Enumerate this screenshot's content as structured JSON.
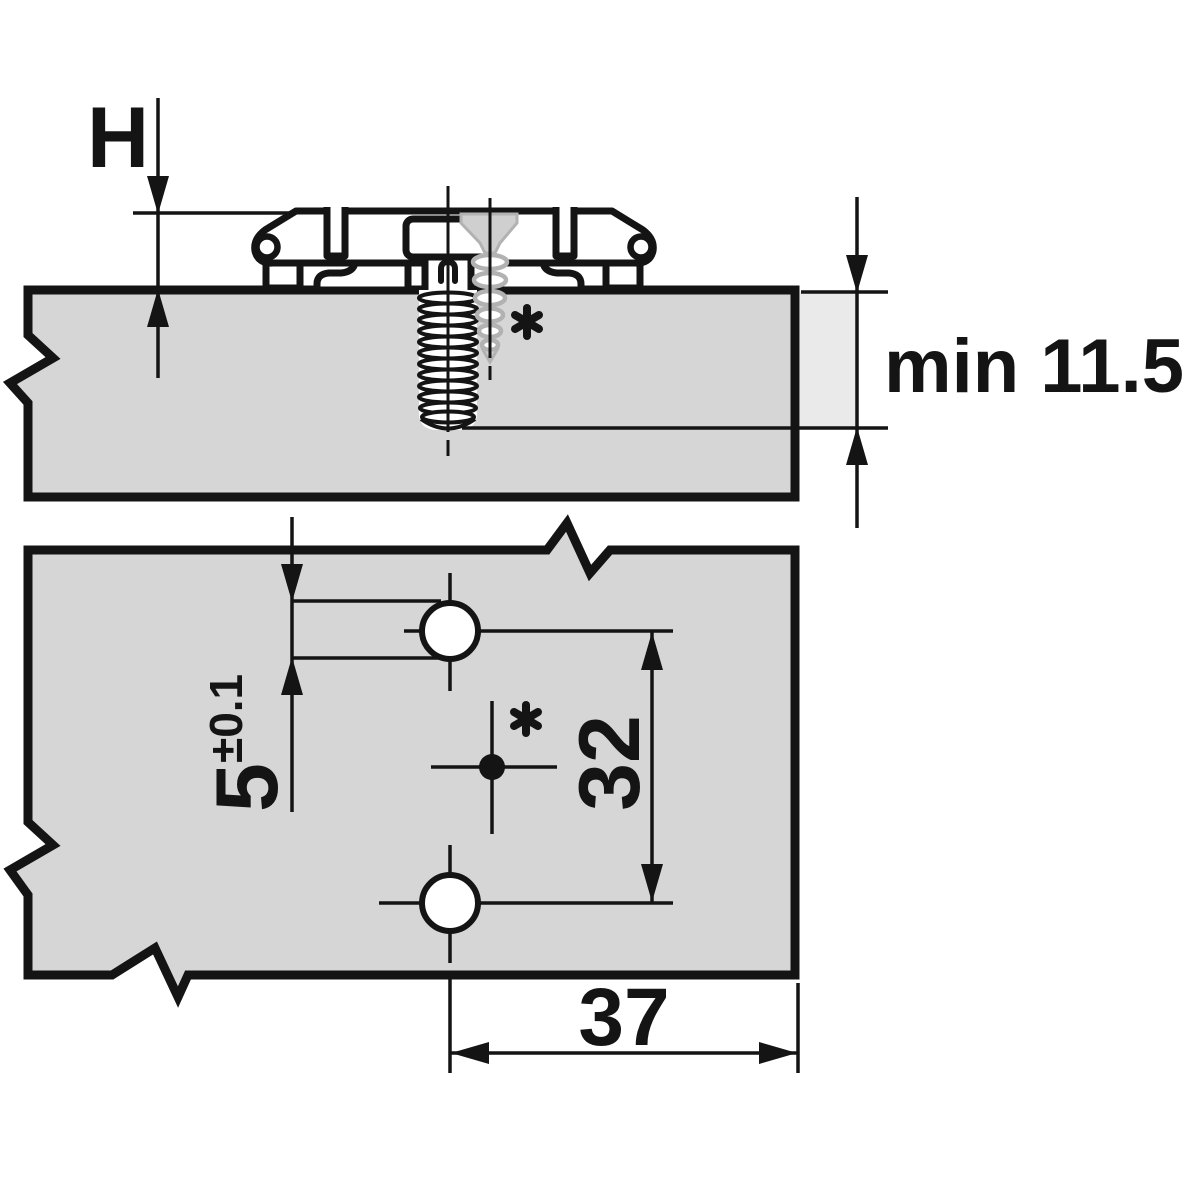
{
  "title": "Mounting plate installation drawing",
  "colors": {
    "line": "#141414",
    "board_fill": "#d6d6d6",
    "depth_zone_fill": "#eaeaea",
    "phantom_screw": "#b2b2b2",
    "phantom_screw_fill": "#cfcfcf",
    "background": "#ffffff"
  },
  "section_side_view": {
    "dim_plate_height": {
      "label": "H"
    },
    "dim_min_depth": {
      "label": "min 11.5"
    },
    "footnote_marker": "*"
  },
  "section_top_view": {
    "dim_hole_diameter": {
      "value": "5",
      "tolerance": "±0.1"
    },
    "dim_hole_spacing": {
      "value": "32"
    },
    "dim_edge_distance": {
      "value": "37"
    },
    "footnote_marker": "*"
  }
}
